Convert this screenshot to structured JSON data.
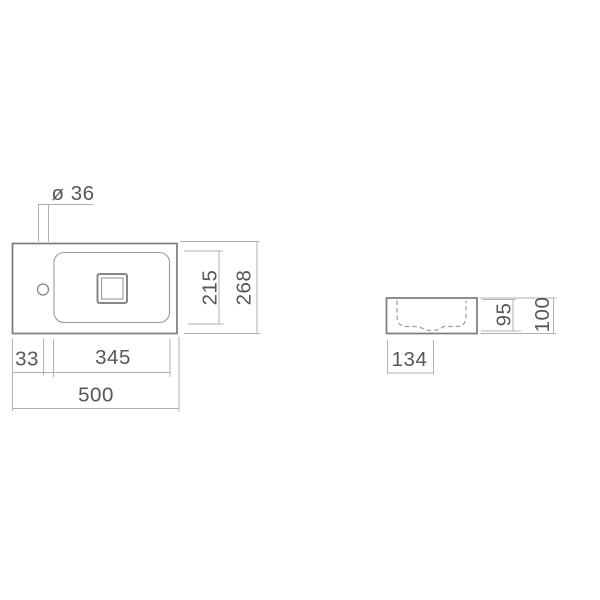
{
  "drawing": {
    "kind": "washbasin-dimension-drawing",
    "colors": {
      "background": "#ffffff",
      "outline": "#7b7b7e",
      "secondary_line": "#9b9b9e",
      "dimension_line": "#b7afad",
      "text": "#57575a"
    },
    "plan_view": {
      "dims": {
        "faucet_hole_diameter": "ø 36",
        "hole_offset": "33",
        "basin_width": "345",
        "overall_width": "500",
        "basin_depth": "215",
        "overall_depth": "268"
      }
    },
    "side_view": {
      "dims": {
        "basin_bottom_width": "134",
        "inner_height": "95",
        "overall_height": "100"
      }
    }
  }
}
